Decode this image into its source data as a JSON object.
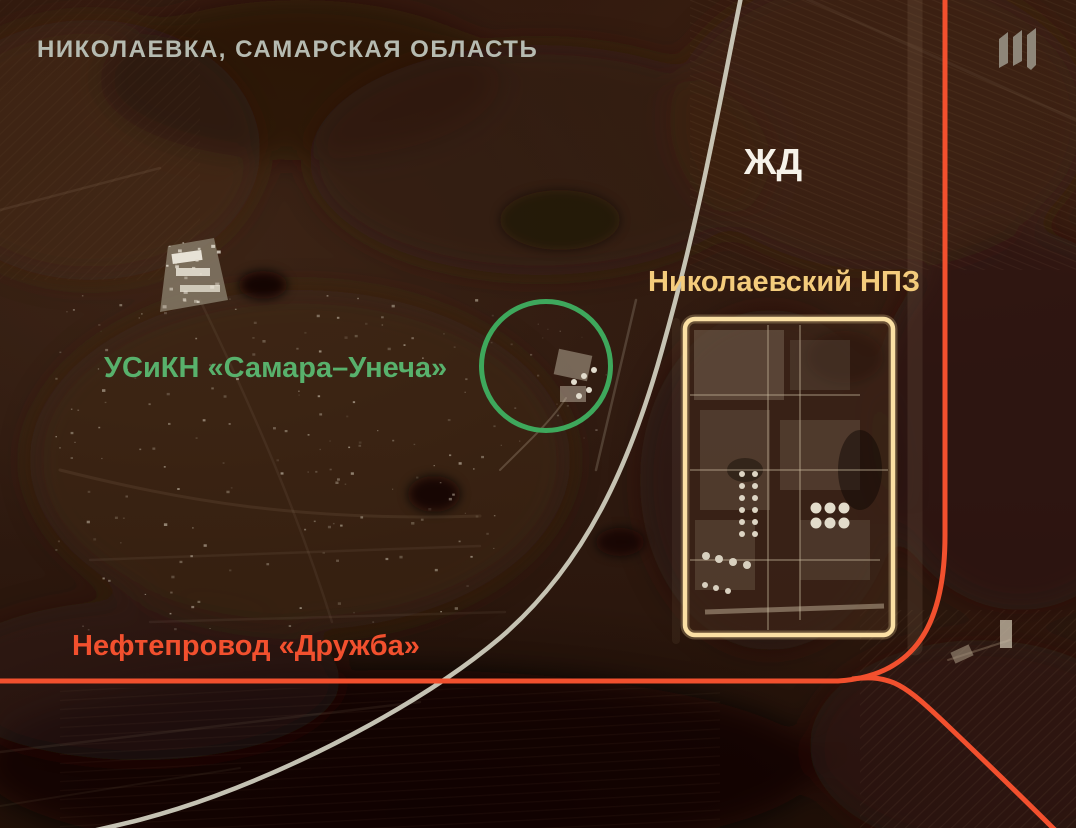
{
  "map": {
    "title": "НИКОЛАЕВКА, САМАРСКАЯ ОБЛАСТЬ",
    "labels": {
      "railway": "ЖД",
      "refinery": "Николаевский НПЗ",
      "pump_station": "УСиКН «Самара–Унеча»",
      "pipeline": "Нефтепровод «Дружба»"
    },
    "icons": {
      "watermark": "meduza-logo"
    },
    "colors": {
      "title_text": "#b6bbb1",
      "railway_text": "#f6f2e9",
      "railway_line": "#cfccbd",
      "refinery_text": "#f4cc7c",
      "refinery_box": "#fbe0a4",
      "pump_station_text": "#58b16c",
      "pump_station_circle": "#3ea85c",
      "pipeline": "#f2502e",
      "logo": "#8e8679"
    }
  }
}
